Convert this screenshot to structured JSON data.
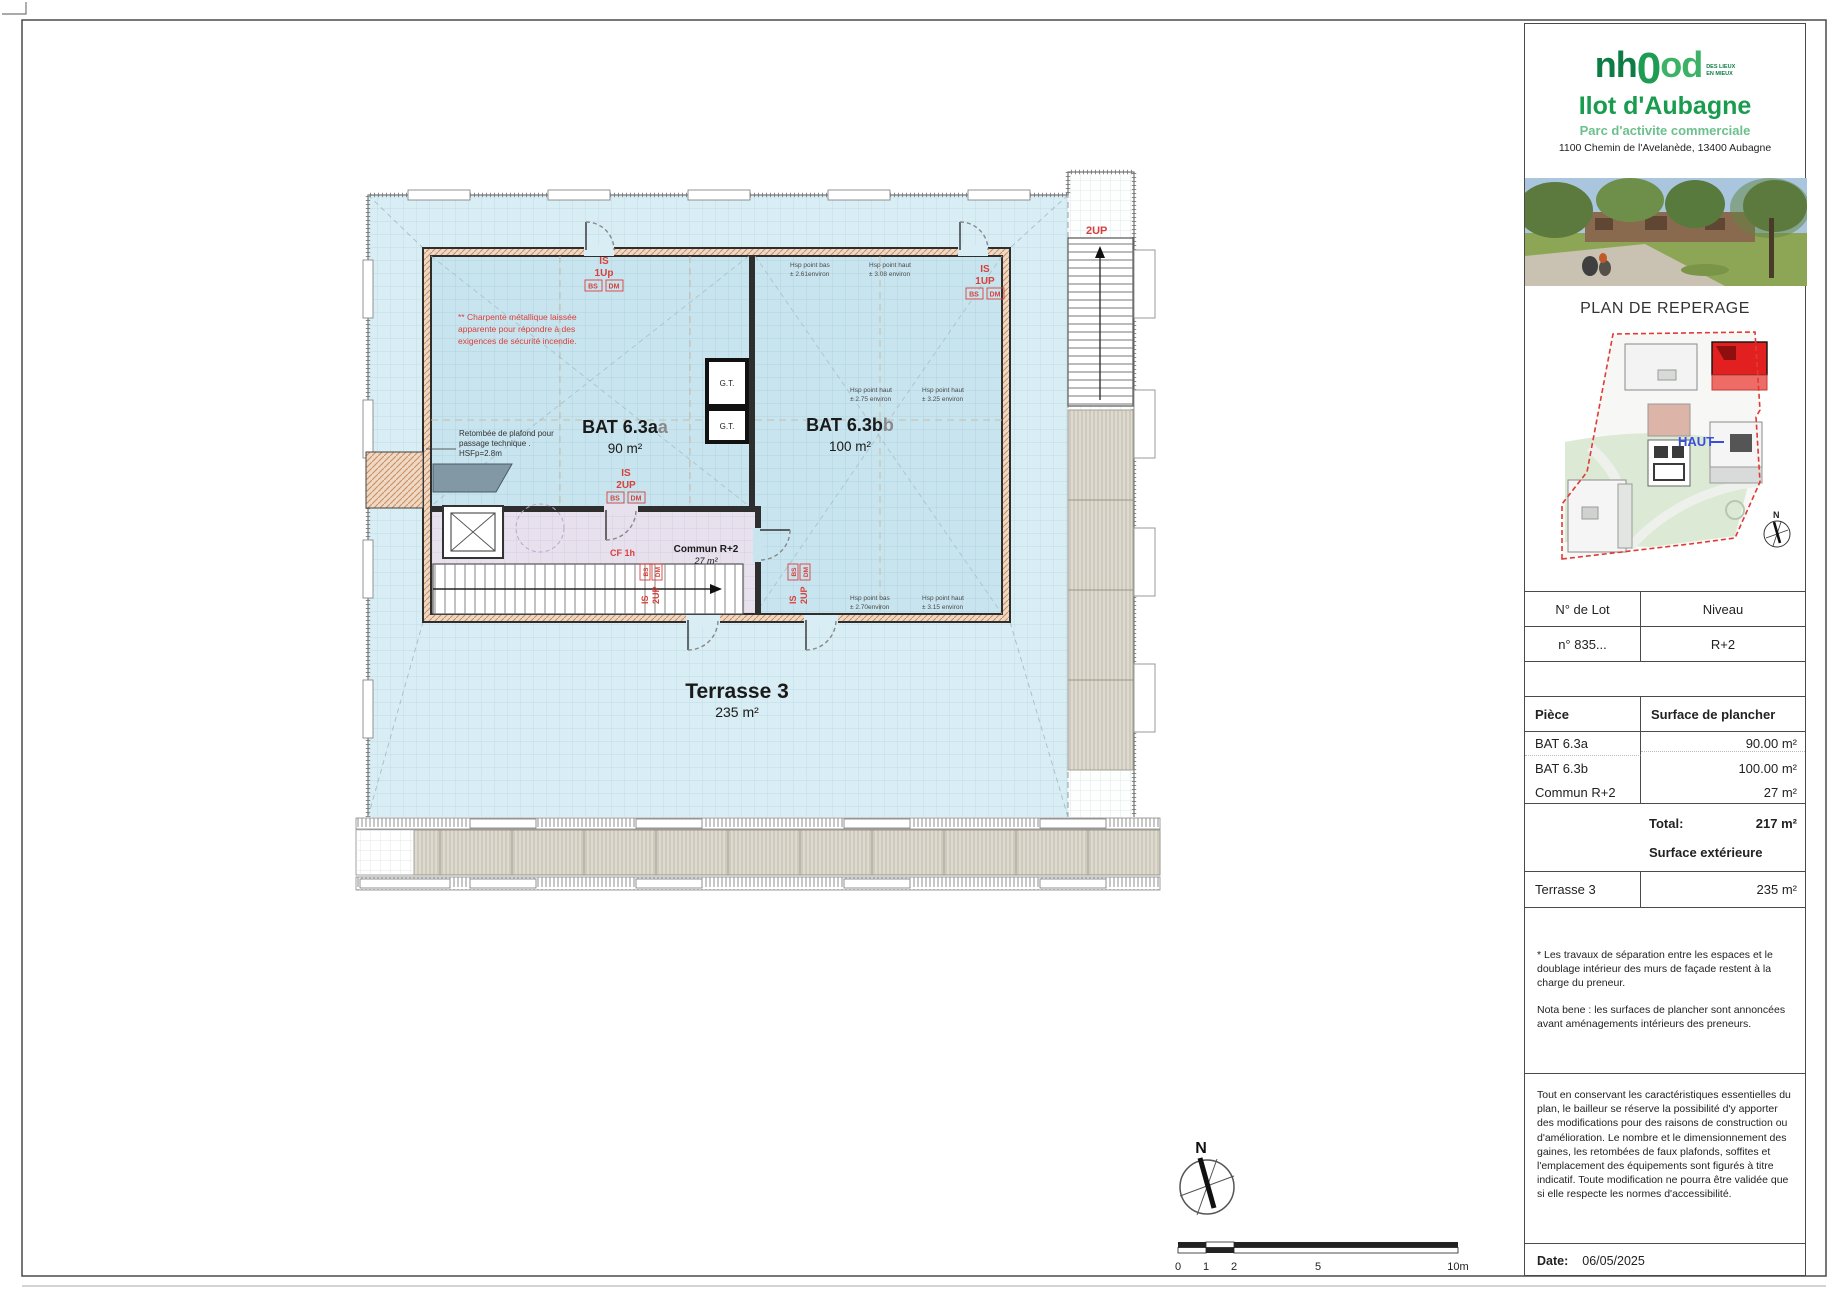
{
  "brand": {
    "logo_nh": "nh",
    "logo_0": "0",
    "logo_od": "od",
    "tagline_line1": "DES LIEUX",
    "tagline_line2": "EN MIEUX",
    "title": "Ilot d'Aubagne",
    "subtitle": "Parc d'activite commerciale",
    "address": "1100 Chemin de l'Avelanède, 13400 Aubagne"
  },
  "reperage": {
    "heading": "PLAN DE REPERAGE",
    "haut_label": "HAUT",
    "north_label": "N"
  },
  "lot_table": {
    "col1_header": "N° de Lot",
    "col2_header": "Niveau",
    "lot_number": "n° 835...",
    "level": "R+2"
  },
  "surface_table": {
    "col1_header": "Pièce",
    "col2_header": "Surface de plancher",
    "rows": [
      {
        "label": "BAT 6.3a",
        "value": "90.00 m²"
      },
      {
        "label": "BAT 6.3b",
        "value": "100.00 m²"
      },
      {
        "label": "Commun R+2",
        "value": "27 m²"
      }
    ],
    "total_label": "Total:",
    "total_value": "217 m²",
    "exterior_header": "Surface extérieure",
    "exterior_row": {
      "label": "Terrasse 3",
      "value": "235 m²"
    }
  },
  "notes": {
    "note1": "* Les travaux de séparation entre les espaces et le doublage intérieur des murs de façade restent à la charge du preneur.",
    "note2": "Nota bene : les surfaces de plancher sont annoncées avant aménagements intérieurs des preneurs.",
    "legal": "Tout en conservant les caractéristiques essentielles du plan, le bailleur se réserve la possibilité d'y apporter des modifications pour des raisons de construction ou d'amélioration. Le nombre et le dimensionnement des gaines, les retombées de faux plafonds, soffites et l'emplacement des équipements sont figurés à titre indicatif. Toute modification ne pourra être validée que si elle respecte les normes d'accessibilité.",
    "date_label": "Date:",
    "date_value": "06/05/2025"
  },
  "plan": {
    "bat_a_name": "BAT 6.3a",
    "bat_a_suffix": "a",
    "bat_a_area": "90 m²",
    "bat_b_name": "BAT 6.3b",
    "bat_b_suffix": "b",
    "bat_b_area": "100 m²",
    "commun_name": "Commun R+2",
    "commun_area": "27 m²",
    "terrasse_name": "Terrasse 3",
    "terrasse_area": "235 m²",
    "gt_label": "G.T.",
    "charpente_l1": "** Charpente métallique laissée",
    "charpente_l2": "apparente pour répondre à des",
    "charpente_l3": "exigences de sécurité incendie.",
    "retombee_l1": "Retombée de plafond pour",
    "retombee_l2": "passage technique .",
    "retombee_l3": "HSFp=2.8m",
    "is": "IS",
    "up1": "1Up",
    "up1b": "1UP",
    "up2": "2UP",
    "bs": "BS",
    "dm": "DM",
    "cf1h": "CF 1h",
    "stair_2up": "2UP",
    "north_label": "N",
    "hsp": {
      "t1_l1": "Hsp point bas",
      "t1_l2": "± 2.61environ",
      "t2_l1": "Hsp point haut",
      "t2_l2": "± 3.08 environ",
      "m1_l1": "Hsp point haut",
      "m1_l2": "± 2.75 environ",
      "m2_l1": "Hsp point haut",
      "m2_l2": "± 3.25 environ",
      "b1_l1": "Hsp point bas",
      "b1_l2": "± 2.70environ",
      "b2_l1": "Hsp point haut",
      "b2_l2": "± 3.15 environ"
    }
  },
  "scalebar": {
    "labels": [
      "0",
      "1",
      "2",
      "5",
      "10m"
    ]
  },
  "colors": {
    "brand_green": "#1a9c4f",
    "annotation_red": "#d9403a",
    "terrace_blue": "#d9edf4",
    "building_blue": "#c8e4ef",
    "commun_lavender": "#e7e0ed"
  }
}
